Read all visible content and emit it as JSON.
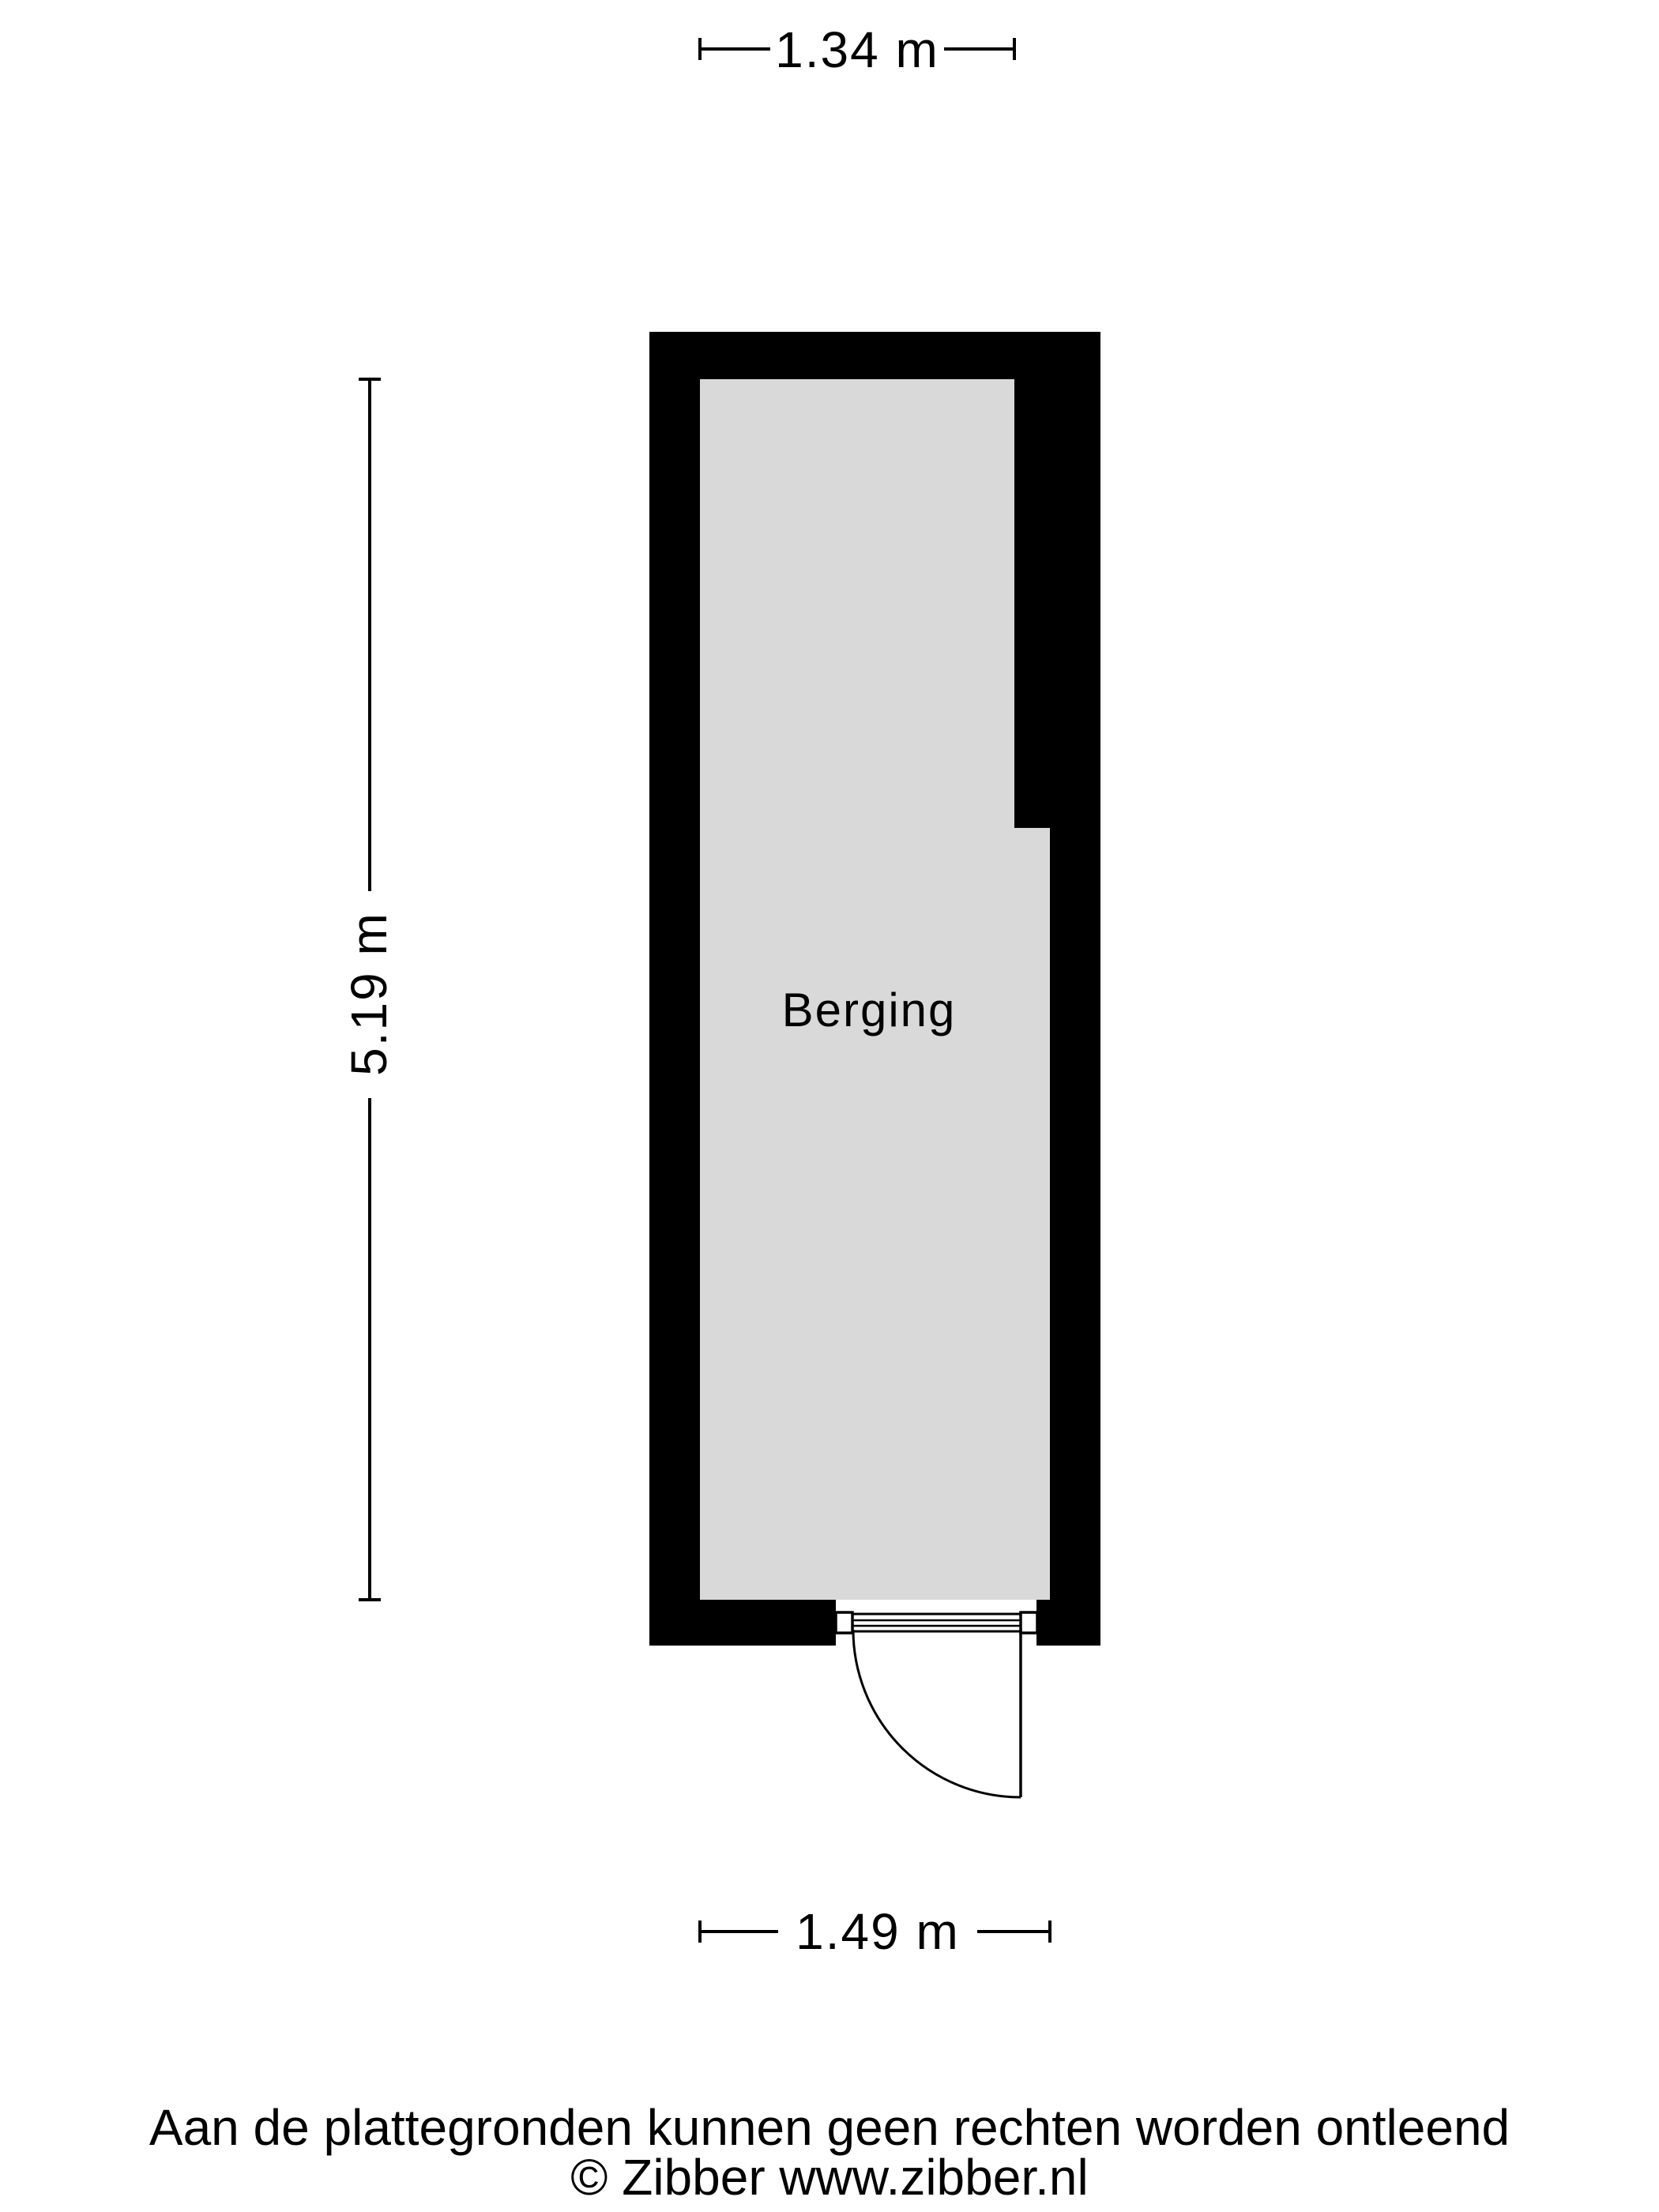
{
  "floorplan": {
    "room_label": "Berging",
    "colors": {
      "wall": "#000000",
      "floor": "#d9d9d9",
      "line": "#000000",
      "background": "#ffffff"
    },
    "dimensions": {
      "top": "1.34 m",
      "left": "5.19 m",
      "bottom": "1.49 m"
    }
  },
  "footer": {
    "disclaimer": "Aan de plattegronden kunnen geen rechten worden ontleend",
    "copyright": "© Zibber www.zibber.nl"
  }
}
